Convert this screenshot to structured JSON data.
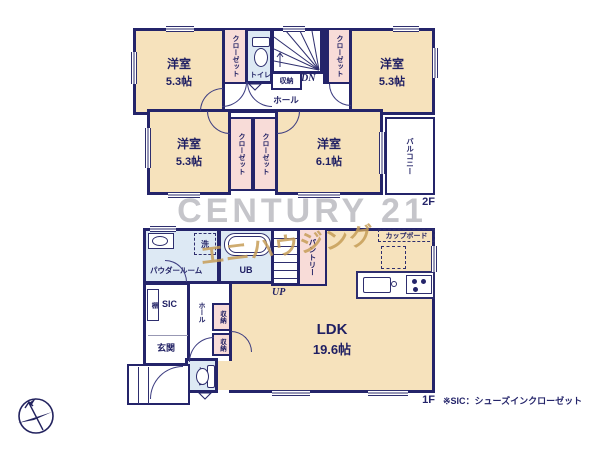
{
  "palette": {
    "wall": "#24246a",
    "floor": "#f6e2bc",
    "closet_pink": "#f8dcd8",
    "wet_blue": "#dde9f4",
    "watermark_gray": "#a3a3ab",
    "watermark_gold": "#c79e58"
  },
  "floor2": {
    "label": "2F",
    "room_nw": {
      "name": "洋室",
      "size": "5.3帖"
    },
    "room_ne": {
      "name": "洋室",
      "size": "5.3帖"
    },
    "room_sw": {
      "name": "洋室",
      "size": "5.3帖"
    },
    "room_se": {
      "name": "洋室",
      "size": "6.1帖"
    },
    "closet": "クローゼット",
    "toilet": "トイレ",
    "storage": "収納",
    "hall": "ホール",
    "stairs_dn": "DN",
    "balcony": "バルコニー"
  },
  "floor1": {
    "label": "1F",
    "ldk": {
      "name": "LDK",
      "size": "19.6帖"
    },
    "powder": "パウダールーム",
    "wash": "洗",
    "bath": "UB",
    "stairs_up": "UP",
    "pantry": "パントリー",
    "cupboard": "カップボード",
    "sic": "SIC",
    "shelf": "棚",
    "hall": "ホール",
    "storage": "収納",
    "entrance": "玄関",
    "toilet": "トイレ"
  },
  "watermark": {
    "brand": "CENTURY 21",
    "company": "エニハウジング"
  },
  "footnote": "※SIC：シューズインクローゼット",
  "icons": {
    "compass": "north-compass"
  }
}
